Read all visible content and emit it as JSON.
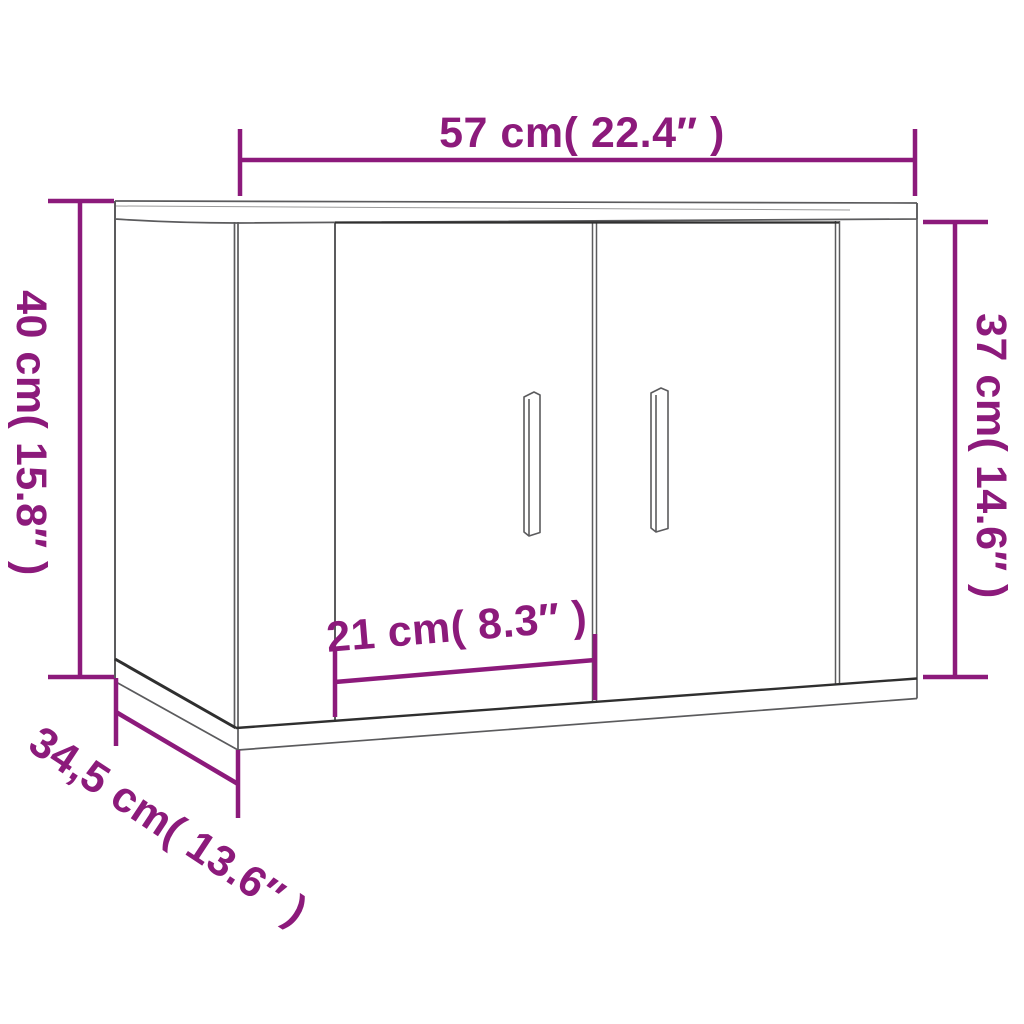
{
  "colors": {
    "dimension": "#8C1A7B",
    "line": "#5B5B5D",
    "line_light": "#9A9A9A",
    "line_dark": "#2F2F2F",
    "background": "#FFFFFF"
  },
  "diagram": {
    "labels": {
      "width": {
        "text": "57 cm( 22.4″ )",
        "cm": 57,
        "inches": 22.4
      },
      "height_left": {
        "text": "40 cm( 15.8″ )",
        "cm": 40,
        "inches": 15.8
      },
      "height_right": {
        "text": "37 cm( 14.6″ )",
        "cm": 37,
        "inches": 14.6
      },
      "door_width": {
        "text": "21 cm( 8.3″ )",
        "cm": 21,
        "inches": 8.3
      },
      "depth": {
        "text": "34,5 cm( 13.6″ )",
        "cm": 34.5,
        "inches": 13.6
      }
    }
  }
}
